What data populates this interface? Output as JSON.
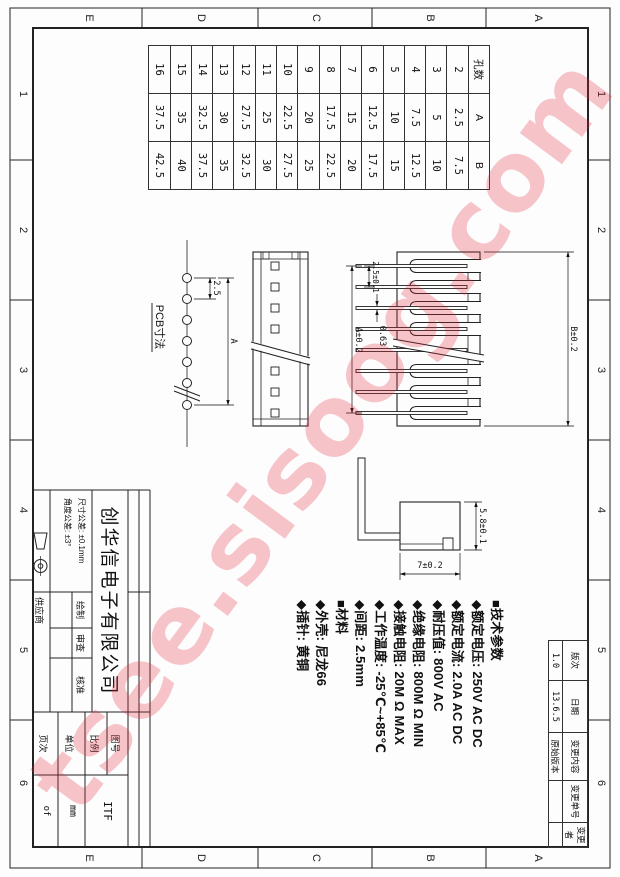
{
  "sheet": {
    "zones": {
      "letters": [
        "A",
        "B",
        "C",
        "D",
        "E"
      ],
      "numbers": [
        "1",
        "2",
        "3",
        "4",
        "5",
        "6"
      ]
    }
  },
  "pin_table": {
    "headers": [
      "孔数",
      "A",
      "B"
    ],
    "rows": [
      [
        "2",
        "2.5",
        "7.5"
      ],
      [
        "3",
        "5",
        "10"
      ],
      [
        "4",
        "7.5",
        "12.5"
      ],
      [
        "5",
        "10",
        "15"
      ],
      [
        "6",
        "12.5",
        "17.5"
      ],
      [
        "7",
        "15",
        "20"
      ],
      [
        "8",
        "17.5",
        "22.5"
      ],
      [
        "9",
        "20",
        "25"
      ],
      [
        "10",
        "22.5",
        "27.5"
      ],
      [
        "11",
        "25",
        "30"
      ],
      [
        "12",
        "27.5",
        "32.5"
      ],
      [
        "13",
        "30",
        "35"
      ],
      [
        "14",
        "32.5",
        "37.5"
      ],
      [
        "15",
        "35",
        "40"
      ],
      [
        "16",
        "37.5",
        "42.5"
      ]
    ]
  },
  "revision_table": {
    "headers": [
      "版次",
      "日期",
      "变更内容",
      "变更单号",
      "变更者"
    ],
    "values": [
      "1.0",
      "13.6.5",
      "原始版本",
      "",
      ""
    ]
  },
  "tech_params": {
    "lines": [
      "■技术参数",
      "◆额定电压: 250V AC DC",
      "◆额定电流: 2.0A AC DC",
      "◆耐压值: 800V AC",
      "◆绝缘电阻: 800M Ω MIN",
      "◆接触电阻: 20M Ω MAX",
      "◆工作温度: -25℃~+85℃",
      "◆间距: 2.5mm",
      "■材料",
      "◆外壳: 尼龙66",
      "◆插针: 黄铜"
    ]
  },
  "views": {
    "front": {
      "dim_pitch": "2.5±0.1",
      "dim_pin_width": "0.63",
      "dim_span": "A±0.2",
      "dim_length": "B±0.2"
    },
    "side": {
      "dim_height": "5.8±0.1",
      "dim_depth": "7±0.2"
    },
    "pcb": {
      "label": "PCB寸法",
      "dim_pitch": "2.5",
      "dim_span": "A"
    }
  },
  "title_block": {
    "company": "创华信电子有限公司",
    "tolerances": [
      "尺寸公差: ±0.1mm",
      "角度公差: ±3°"
    ],
    "fields": {
      "drafted": "绘制",
      "checked": "审查",
      "approved": "核准",
      "supplier": "供应商",
      "drawing_no": "图号",
      "scale": "比例",
      "unit": "单位",
      "page": "页次"
    },
    "values": {
      "drawing_no": "ITF",
      "unit": "mm",
      "page": "of"
    }
  },
  "watermark": {
    "text": "tsee.sisoog.com",
    "color": "#e32636"
  }
}
